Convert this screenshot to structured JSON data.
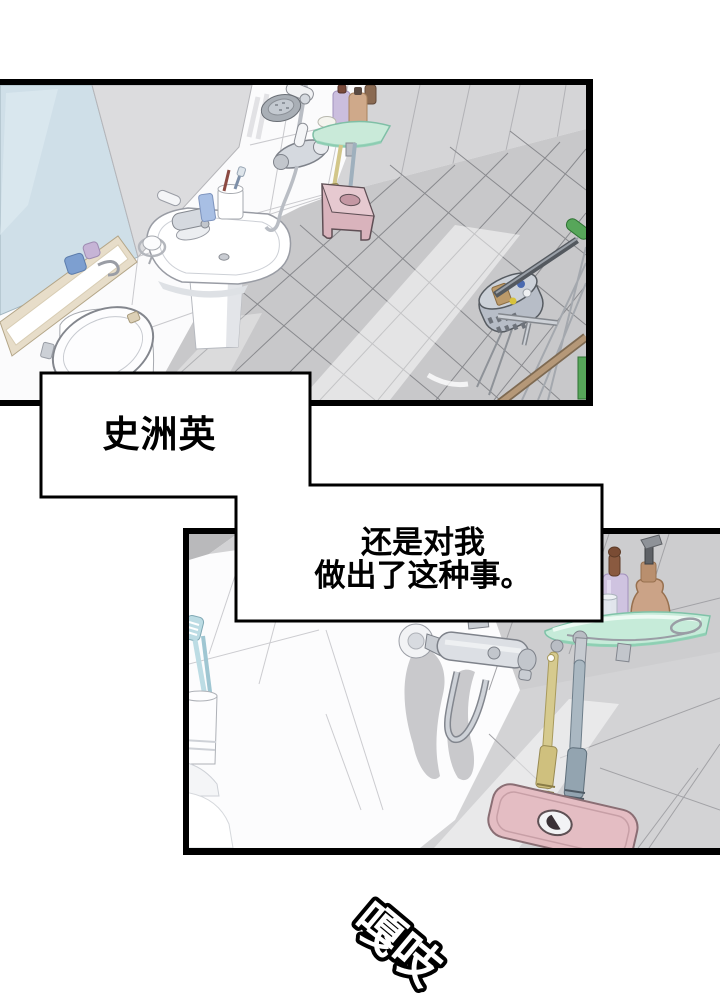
{
  "speech": {
    "box1": "史洲英",
    "box2_line1": "还是对我",
    "box2_line2": "做出了这种事。"
  },
  "sfx": {
    "text": "嘎吱"
  },
  "panels": {
    "top": [
      "mirror",
      "shelf-niche",
      "sink",
      "faucet",
      "toothbrush-cup",
      "toilet",
      "shower-set",
      "soap-dish",
      "corner-shelf",
      "pink-stool",
      "cleaning-basket",
      "green-mop",
      "wood-stick"
    ],
    "bottom": [
      "toothbrush-cup",
      "shower-faucet",
      "hose",
      "glass-shelf",
      "lavender-bottle",
      "amber-pump-bottle",
      "glass-cup",
      "hanging-brushes",
      "pink-toilet-tank"
    ]
  },
  "colors": {
    "panel_border": "#000000",
    "bubble_fill": "#ffffff",
    "bubble_border": "#000000",
    "mirror_blue": "#cfdfe8",
    "tile_gray": "#c8c8ca",
    "shelf_mint": "#c6ebd9",
    "stool_pink": "#d9b3bc",
    "toilet_pink": "#e4bdc3",
    "mop_green": "#57a65a",
    "amber_bottle": "#cba387",
    "lavender_bottle": "#cfc3e0"
  }
}
